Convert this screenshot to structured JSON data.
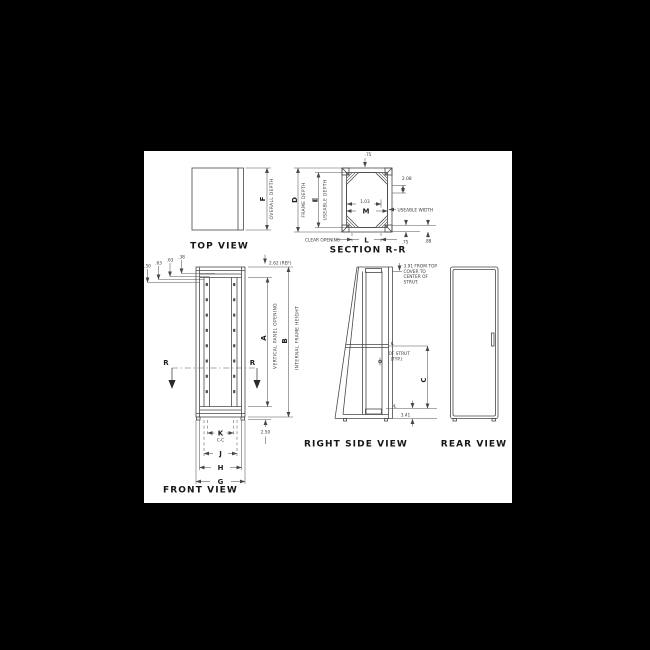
{
  "sheet": {
    "background": "#000000",
    "paper": "#ffffff",
    "ink": "#474747"
  },
  "views": {
    "top": {
      "title": "TOP VIEW",
      "dim_f": {
        "letter": "F",
        "label": "OVERALL DEPTH"
      }
    },
    "section": {
      "title": "SECTION R-R",
      "dim_d": {
        "letter": "D",
        "label": "FRAME DEPTH"
      },
      "dim_e": {
        "letter": "E",
        "label": "USEABLE DEPTH"
      },
      "dim_m": {
        "letter": "M",
        "label": "USEABLE WIDTH"
      },
      "dim_l": {
        "letter": "L",
        "label": "CLEAR OPENING"
      },
      "val_top": ".75",
      "val_gusset": "2.08",
      "val_mid": "1.03",
      "val_flange1": ".75",
      "val_flange2": ".88"
    },
    "front": {
      "title": "FRONT VIEW",
      "dim_a": {
        "letter": "A",
        "label": "VERTICAL PANEL OPENING"
      },
      "dim_b": {
        "letter": "B",
        "label": "INTERNAL FRAME HEIGHT"
      },
      "dim_g": "G",
      "dim_h": "H",
      "dim_j": "J",
      "dim_k": "K",
      "k_sub": "C-C",
      "section_cut": "R",
      "top_offsets": [
        ".50",
        ".63",
        ".63",
        ".38"
      ],
      "ref_top": "2.62 (REF)",
      "val_bottom": "2.50"
    },
    "side": {
      "title": "RIGHT SIDE VIEW",
      "note_lines": [
        "3.91 FROM TOP",
        "COVER TO",
        "CENTER OF",
        "STRUT."
      ],
      "strut_cl": "℄",
      "strut_label1": "OF STRUT",
      "strut_label2": "(TYP.)",
      "dim_c": "C",
      "val_bottom": "3.41"
    },
    "rear": {
      "title": "REAR VIEW"
    }
  }
}
